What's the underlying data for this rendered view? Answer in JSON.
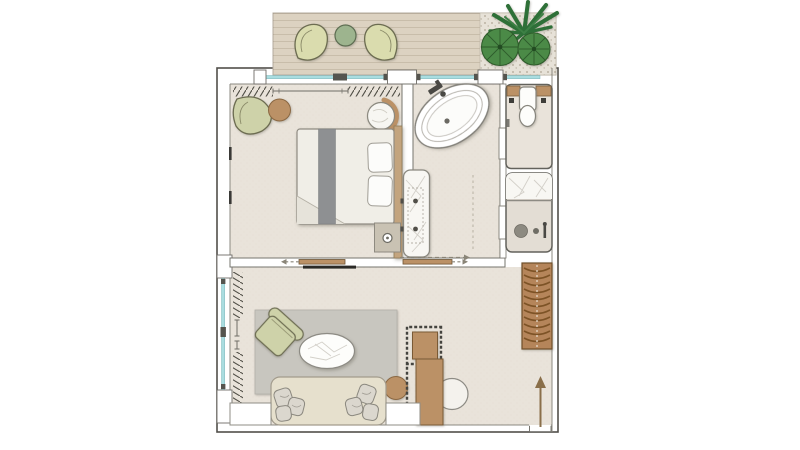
{
  "document": {
    "kind": "architectural-floor-plan",
    "description_names": [
      "hotel-suite-plan"
    ],
    "rooms": [
      {
        "id": "terrace",
        "name": "terrace",
        "furniture": [
          "lounge-chair-left",
          "round-terrace-table",
          "lounge-chair-right",
          "potted-plant",
          "gravel-bed",
          "deck-planks"
        ]
      },
      {
        "id": "bedroom",
        "name": "bedroom",
        "furniture": [
          "curtain-left",
          "curtain-rod",
          "curtain-right",
          "armchair",
          "round-side-table",
          "rattan-chair",
          "double-bed",
          "bed-runner",
          "pillow",
          "pillow",
          "headboard",
          "foot-bench",
          "wall-mirror-strips",
          "sliding-door-left",
          "sliding-door-right",
          "tv-panel"
        ]
      },
      {
        "id": "bathroom",
        "name": "bathroom",
        "furniture": [
          "freestanding-bathtub",
          "tub-faucet",
          "marble-vanity",
          "double-basin-dots",
          "circulation-arrow"
        ]
      },
      {
        "id": "wc",
        "name": "water-closet",
        "furniture": [
          "wood-shelf",
          "toilet",
          "pocket-door"
        ]
      },
      {
        "id": "shower",
        "name": "shower-room",
        "furniture": [
          "marble-bench",
          "floor-drain",
          "shower-valve",
          "pocket-door"
        ]
      },
      {
        "id": "living",
        "name": "living-room",
        "furniture": [
          "window-curtains",
          "area-rug",
          "lounge-armchair",
          "oval-coffee-table",
          "round-side-table",
          "sofa",
          "throw-cushions",
          "desk",
          "desk-stool-dotted-canopy",
          "desk-chair",
          "louvered-wardrobe",
          "entry-arrow",
          "wall-niche-left",
          "wall-niche-right"
        ]
      }
    ],
    "glazing_runs": [
      "top-window-wall",
      "left-window-wall"
    ],
    "circulation": [
      "slide-arrow-left",
      "slide-arrow-right",
      "bath-corridor-arrow",
      "entry-arrow-up"
    ]
  },
  "colors": {
    "page_bg": "#ffffff",
    "floor": "#e9e3da",
    "floor_shower": "#e3ddd4",
    "wall_fill": "#ffffff",
    "wall_line": "#514f4a",
    "inner_line": "#8b8880",
    "deck_wood": "#dcd2c1",
    "gravel": "#e7e2d8",
    "glazing": "#a9dde0",
    "glazing_edge": "#7fb6ba",
    "mullion": "#55544e",
    "sage": "#ced2a9",
    "sage_pale": "#dadcae",
    "sage_edge": "#6c6c51",
    "table_green": "#9db48e",
    "table_green_edge": "#5d6d51",
    "wood": "#bb9166",
    "wood_edge": "#8a6742",
    "wardrobe": "#b5855a",
    "wardrobe_slat": "#7d5327",
    "plant_dark": "#2e6f37",
    "plant_leaf": "#4b8a47",
    "plant_vein": "#2f5c2c",
    "rug": "#c8c6bf",
    "sofa": "#e6e0cd",
    "cushion": "#dbd7ce",
    "duvet": "#f0eee7",
    "runner": "#8e9092",
    "pillow": "#fcfcfa",
    "bench": "#c9c2b3",
    "headboard": "#c3a47e",
    "marble": "#f8f7f3",
    "marble_vein": "#d3d0c9",
    "white_fixture": "#fdfdfb",
    "fixture_dark": "#4a4945",
    "tv": "#2b2a27",
    "arrow_brown": "#8a6f4a",
    "dash": "#8a8578"
  }
}
